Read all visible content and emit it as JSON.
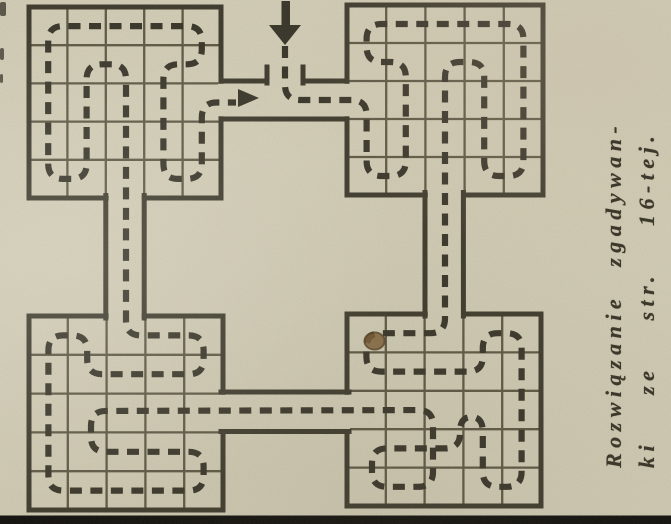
{
  "caption": {
    "line1": "Rozwiązanie zgadywan-",
    "line2": "ki ze str. 16-tej."
  },
  "palette": {
    "paper": "#d5d0b9",
    "ink": "#353227",
    "wall": "#3b382b",
    "grid_line": "#46432f",
    "stain_fill": "#7d5c31",
    "stain_edge": "#4f3a1b",
    "scan_bar": "#0b0a08",
    "edge_mark": "#2e2b22"
  },
  "diagram": {
    "width": 671,
    "height": 524,
    "grids": [
      {
        "id": "top-left",
        "x": 29,
        "y": 7,
        "w": 192,
        "h": 191,
        "cols": 5,
        "rows": 5
      },
      {
        "id": "top-right",
        "x": 347,
        "y": 5,
        "w": 196,
        "h": 190,
        "cols": 5,
        "rows": 5
      },
      {
        "id": "bottom-left",
        "x": 29,
        "y": 316,
        "w": 194,
        "h": 194,
        "cols": 5,
        "rows": 5
      },
      {
        "id": "bottom-right",
        "x": 347,
        "y": 314,
        "w": 194,
        "h": 192,
        "cols": 5,
        "rows": 5
      }
    ],
    "corridor_erase_rects": [
      [
        218,
        83.8,
        131.5,
        32.5
      ],
      [
        108.6,
        194,
        33.2,
        124.5
      ],
      [
        427.8,
        192,
        33.2,
        124.5
      ],
      [
        220,
        394.8,
        130,
        34.2
      ]
    ],
    "corridor_walls": [
      [
        221,
        119,
        347,
        119
      ],
      [
        221,
        81,
        267,
        81
      ],
      [
        303,
        81,
        347,
        81
      ],
      [
        267,
        67,
        267,
        83
      ],
      [
        303,
        67,
        303,
        83
      ],
      [
        105.8,
        195.5,
        105.8,
        318
      ],
      [
        144.2,
        195.5,
        144.2,
        318
      ],
      [
        425,
        192.5,
        425,
        316
      ],
      [
        463.4,
        192.5,
        463.4,
        316
      ],
      [
        221,
        392,
        349,
        392
      ],
      [
        221,
        431.5,
        349,
        431.5
      ]
    ],
    "solution_path": {
      "corner_radius": 15,
      "stroke_width": 6.2,
      "dash": [
        12,
        8.5
      ],
      "points": [
        [
          285,
          46
        ],
        [
          285,
          100
        ],
        [
          366.6,
          100
        ],
        [
          366.6,
          176
        ],
        [
          405.8,
          176
        ],
        [
          405.8,
          62
        ],
        [
          366.6,
          62
        ],
        [
          366.6,
          24
        ],
        [
          523.4,
          24
        ],
        [
          523.4,
          176
        ],
        [
          484.2,
          176
        ],
        [
          484.2,
          62
        ],
        [
          445,
          62
        ],
        [
          445,
          333.2
        ],
        [
          366.4,
          333.2
        ],
        [
          366.4,
          371.6
        ],
        [
          482.8,
          371.6
        ],
        [
          482.8,
          333.2
        ],
        [
          521.6,
          333.2
        ],
        [
          521.6,
          486.8
        ],
        [
          482.8,
          486.8
        ],
        [
          482.8,
          417
        ],
        [
          460,
          417
        ],
        [
          460,
          448.4
        ],
        [
          372,
          448.4
        ],
        [
          372,
          486.8
        ],
        [
          433,
          486.8
        ],
        [
          433,
          410
        ],
        [
          91,
          411
        ],
        [
          91,
          451.8
        ],
        [
          203.6,
          451.8
        ],
        [
          203.6,
          490.6
        ],
        [
          48.4,
          490.6
        ],
        [
          48.4,
          335.4
        ],
        [
          87.2,
          335.4
        ],
        [
          87.2,
          374.2
        ],
        [
          203.6,
          374.2
        ],
        [
          203.6,
          335.4
        ],
        [
          126,
          335.4
        ],
        [
          126,
          64.3
        ],
        [
          86.6,
          64.3
        ],
        [
          86.6,
          178.9
        ],
        [
          48.2,
          178.9
        ],
        [
          48.2,
          26.1
        ],
        [
          201.8,
          26.1
        ],
        [
          201.8,
          64.3
        ],
        [
          163.4,
          64.3
        ],
        [
          163.4,
          178.9
        ],
        [
          201.8,
          178.9
        ],
        [
          201.8,
          102.5
        ],
        [
          236,
          102.5
        ]
      ]
    },
    "entry_arrow": {
      "shaft": [
        281.5,
        1,
        8.5,
        26
      ],
      "head": [
        [
          269,
          25
        ],
        [
          301,
          25
        ],
        [
          285,
          45
        ]
      ]
    },
    "direction_arrow": {
      "head": [
        [
          238,
          89
        ],
        [
          238,
          107
        ],
        [
          259,
          98
        ]
      ]
    },
    "stain": {
      "cx": 374.5,
      "cy": 341,
      "rx": 10,
      "ry": 8.5
    },
    "edge_marks": [
      [
        0,
        2,
        6,
        14
      ],
      [
        0,
        48,
        4,
        12
      ],
      [
        0,
        74,
        3,
        9
      ]
    ],
    "scan_bar": [
      0,
      515.5,
      671,
      8.5
    ]
  }
}
